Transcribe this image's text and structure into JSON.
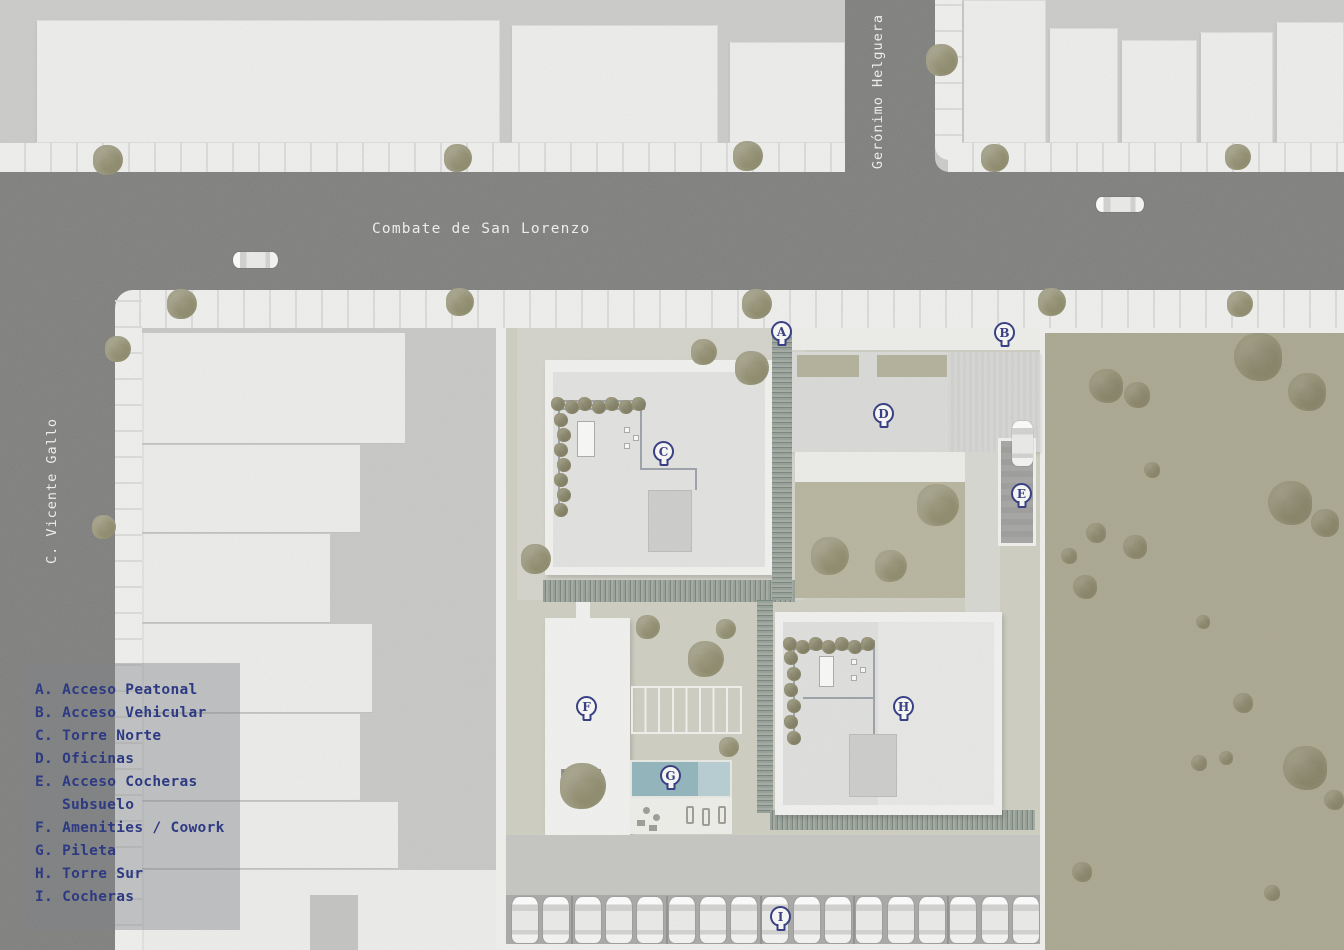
{
  "streets": {
    "horizontal": "Combate de San Lorenzo",
    "vertical_right": "Gerónimo Helguera",
    "vertical_left": "C. Vicente Gallo"
  },
  "legend": {
    "lines": [
      "A. Acceso Peatonal",
      "B. Acceso Vehicular",
      "C. Torre Norte",
      "D. Oficinas",
      "E. Acceso Cocheras",
      "Subsuelo",
      "F. Amenities / Cowork",
      "G. Pileta",
      "H. Torre Sur",
      "I. Cocheras"
    ]
  },
  "markers": [
    {
      "letter": "A",
      "meaning": "Acceso Peatonal",
      "x": 782,
      "y": 332
    },
    {
      "letter": "B",
      "meaning": "Acceso Vehicular",
      "x": 1005,
      "y": 333
    },
    {
      "letter": "C",
      "meaning": "Torre Norte",
      "x": 664,
      "y": 452
    },
    {
      "letter": "D",
      "meaning": "Oficinas",
      "x": 884,
      "y": 414
    },
    {
      "letter": "E",
      "meaning": "Acceso Cocheras Subsuelo",
      "x": 1022,
      "y": 494
    },
    {
      "letter": "F",
      "meaning": "Amenities / Cowork",
      "x": 587,
      "y": 707
    },
    {
      "letter": "G",
      "meaning": "Pileta",
      "x": 671,
      "y": 776
    },
    {
      "letter": "H",
      "meaning": "Torre Sur",
      "x": 904,
      "y": 707
    },
    {
      "letter": "I",
      "meaning": "Cocheras",
      "x": 781,
      "y": 917
    }
  ],
  "counts": {
    "surface_parked_cars": 17,
    "street_cars": 2,
    "ramp_cars": 1
  },
  "colors": {
    "marker_navy": "#2b337e",
    "legend_text": "#1e2c7c",
    "asphalt": "#7d7d7b",
    "sidewalk": "#f1f1ef",
    "building_white": "#efefed",
    "roof_gray": "#e3e3e1",
    "site_ground": "#cfcec1",
    "courtyard_grass": "#b6b49c",
    "vacant_lot": "#a9a68e",
    "tree_olive": "#9b987d",
    "hedge_green": "#87928b",
    "pool_blue": "#8fb3bb",
    "street_label": "#f2f2f0"
  }
}
